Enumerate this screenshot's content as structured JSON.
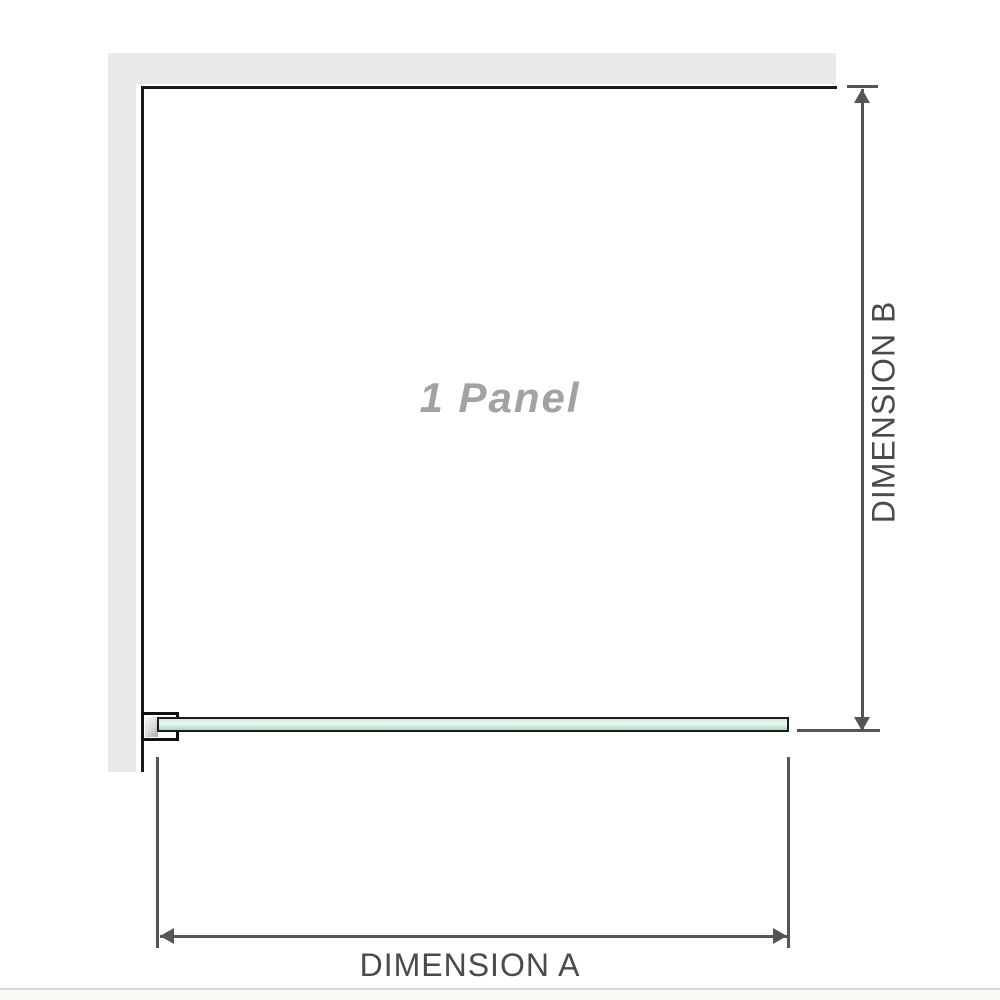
{
  "diagram": {
    "title": "1 panel shower screen dimension diagram",
    "panel_label": "1 Panel",
    "dimension_a_label": "DIMENSION A",
    "dimension_b_label": "DIMENSION B",
    "colors": {
      "wall_fill": "#e9e9e9",
      "panel_border": "#1a1a1a",
      "dimension_line": "#555555",
      "dimension_text": "#4a4a4a",
      "panel_label_text": "#a2a2a2",
      "glass_green_light": "#ecf8f2",
      "glass_green_dark": "#abdcc2",
      "bottom_rule": "#dcd9d3"
    }
  }
}
